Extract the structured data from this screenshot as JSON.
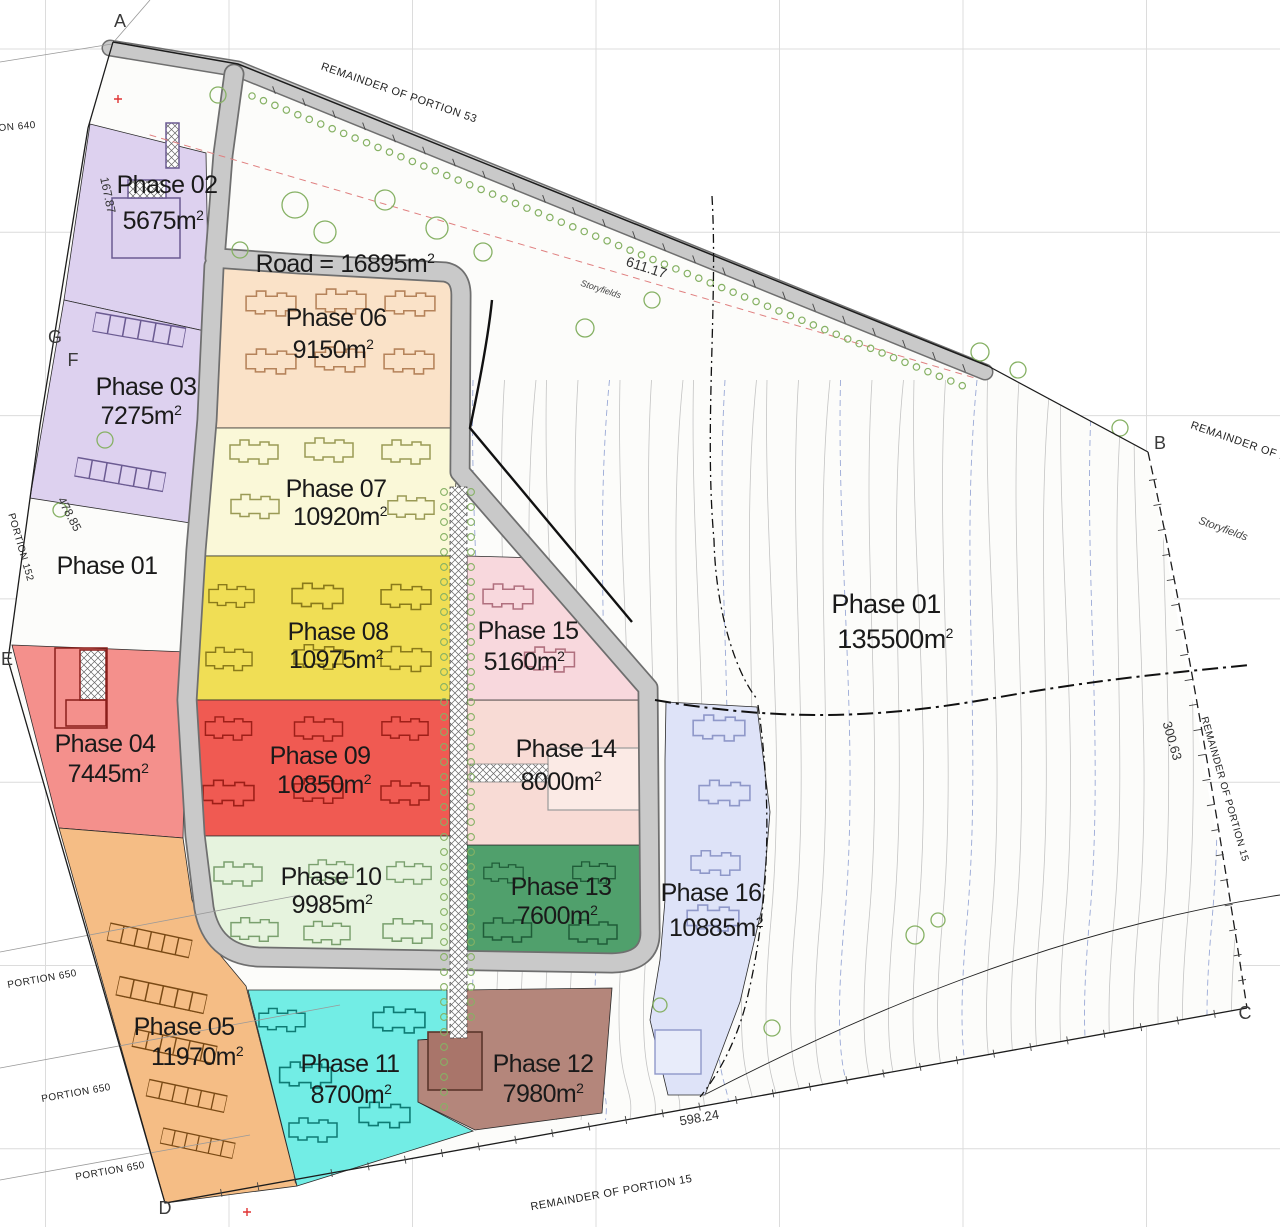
{
  "colors": {
    "road": "#c9c9c9",
    "road_edge": "#6f6f6f",
    "parcel_base": "#fcfcfa",
    "grid": "#dcdcdc",
    "contour": "#c4c4c4",
    "contour_blue": "#9aa9d6",
    "tree": "#86b164",
    "boundary": "#1c1c1c",
    "label_text": "#1a1a1a",
    "red_mark": "#e03434"
  },
  "units": {
    "unit": "m",
    "sup": "2"
  },
  "road_label": {
    "prefix": "Road =",
    "area": "16895"
  },
  "phases": [
    {
      "key": "phase-01-left",
      "name": "Phase 01",
      "area": "",
      "color": ""
    },
    {
      "key": "phase-01",
      "name": "Phase 01",
      "area": "135500",
      "color": ""
    },
    {
      "key": "phase-02",
      "name": "Phase 02",
      "area": "5675",
      "color": "#ddd1ef"
    },
    {
      "key": "phase-03",
      "name": "Phase 03",
      "area": "7275",
      "color": "#ddd1ef"
    },
    {
      "key": "phase-04",
      "name": "Phase 04",
      "area": "7445",
      "color": "#f4908c"
    },
    {
      "key": "phase-05",
      "name": "Phase 05",
      "area": "11970",
      "color": "#f5bd85"
    },
    {
      "key": "phase-06",
      "name": "Phase 06",
      "area": "9150",
      "color": "#fae2c8"
    },
    {
      "key": "phase-07",
      "name": "Phase 07",
      "area": "10920",
      "color": "#faf8d8"
    },
    {
      "key": "phase-08",
      "name": "Phase 08",
      "area": "10975",
      "color": "#f0de55"
    },
    {
      "key": "phase-09",
      "name": "Phase 09",
      "area": "10850",
      "color": "#f05a52"
    },
    {
      "key": "phase-10",
      "name": "Phase 10",
      "area": "9985",
      "color": "#e6f3de"
    },
    {
      "key": "phase-11",
      "name": "Phase 11",
      "area": "8700",
      "color": "#72ede5"
    },
    {
      "key": "phase-12",
      "name": "Phase 12",
      "area": "7980",
      "color": "#b4867b"
    },
    {
      "key": "phase-13",
      "name": "Phase 13",
      "area": "7600",
      "color": "#50a06c"
    },
    {
      "key": "phase-14",
      "name": "Phase 14",
      "area": "8000",
      "color": "#f8dbd5"
    },
    {
      "key": "phase-15",
      "name": "Phase 15",
      "area": "5160",
      "color": "#f8d8dd"
    },
    {
      "key": "phase-16",
      "name": "Phase 16",
      "area": "10885",
      "color": "#dee3f8"
    }
  ],
  "corner_markers": [
    {
      "label": "A"
    },
    {
      "label": "B"
    },
    {
      "label": "C"
    },
    {
      "label": "D"
    },
    {
      "label": "E"
    },
    {
      "label": "F"
    },
    {
      "label": "G"
    }
  ],
  "annotations": {
    "remainder_top": "REMAINDER OF PORTION 53",
    "remainder_right_upper": "REMAINDER OF PORTION",
    "remainder_right": "REMAINDER OF PORTION 15",
    "remainder_bottom": "REMAINDER OF PORTION 15",
    "storyfields_center": "Storyfields",
    "storyfields_right": "Storyfields",
    "portion_152": "PORTION 152",
    "portion_640": "PORTION 640",
    "portion_650_a": "PORTION 650",
    "portion_650_b": "PORTION 650",
    "portion_650_c": "PORTION 650",
    "dim_road_top": "611.17",
    "dim_left_mid": "478.85",
    "dim_left_upper": "167.87",
    "dim_right": "300.63",
    "dim_bottom": "598.24"
  }
}
